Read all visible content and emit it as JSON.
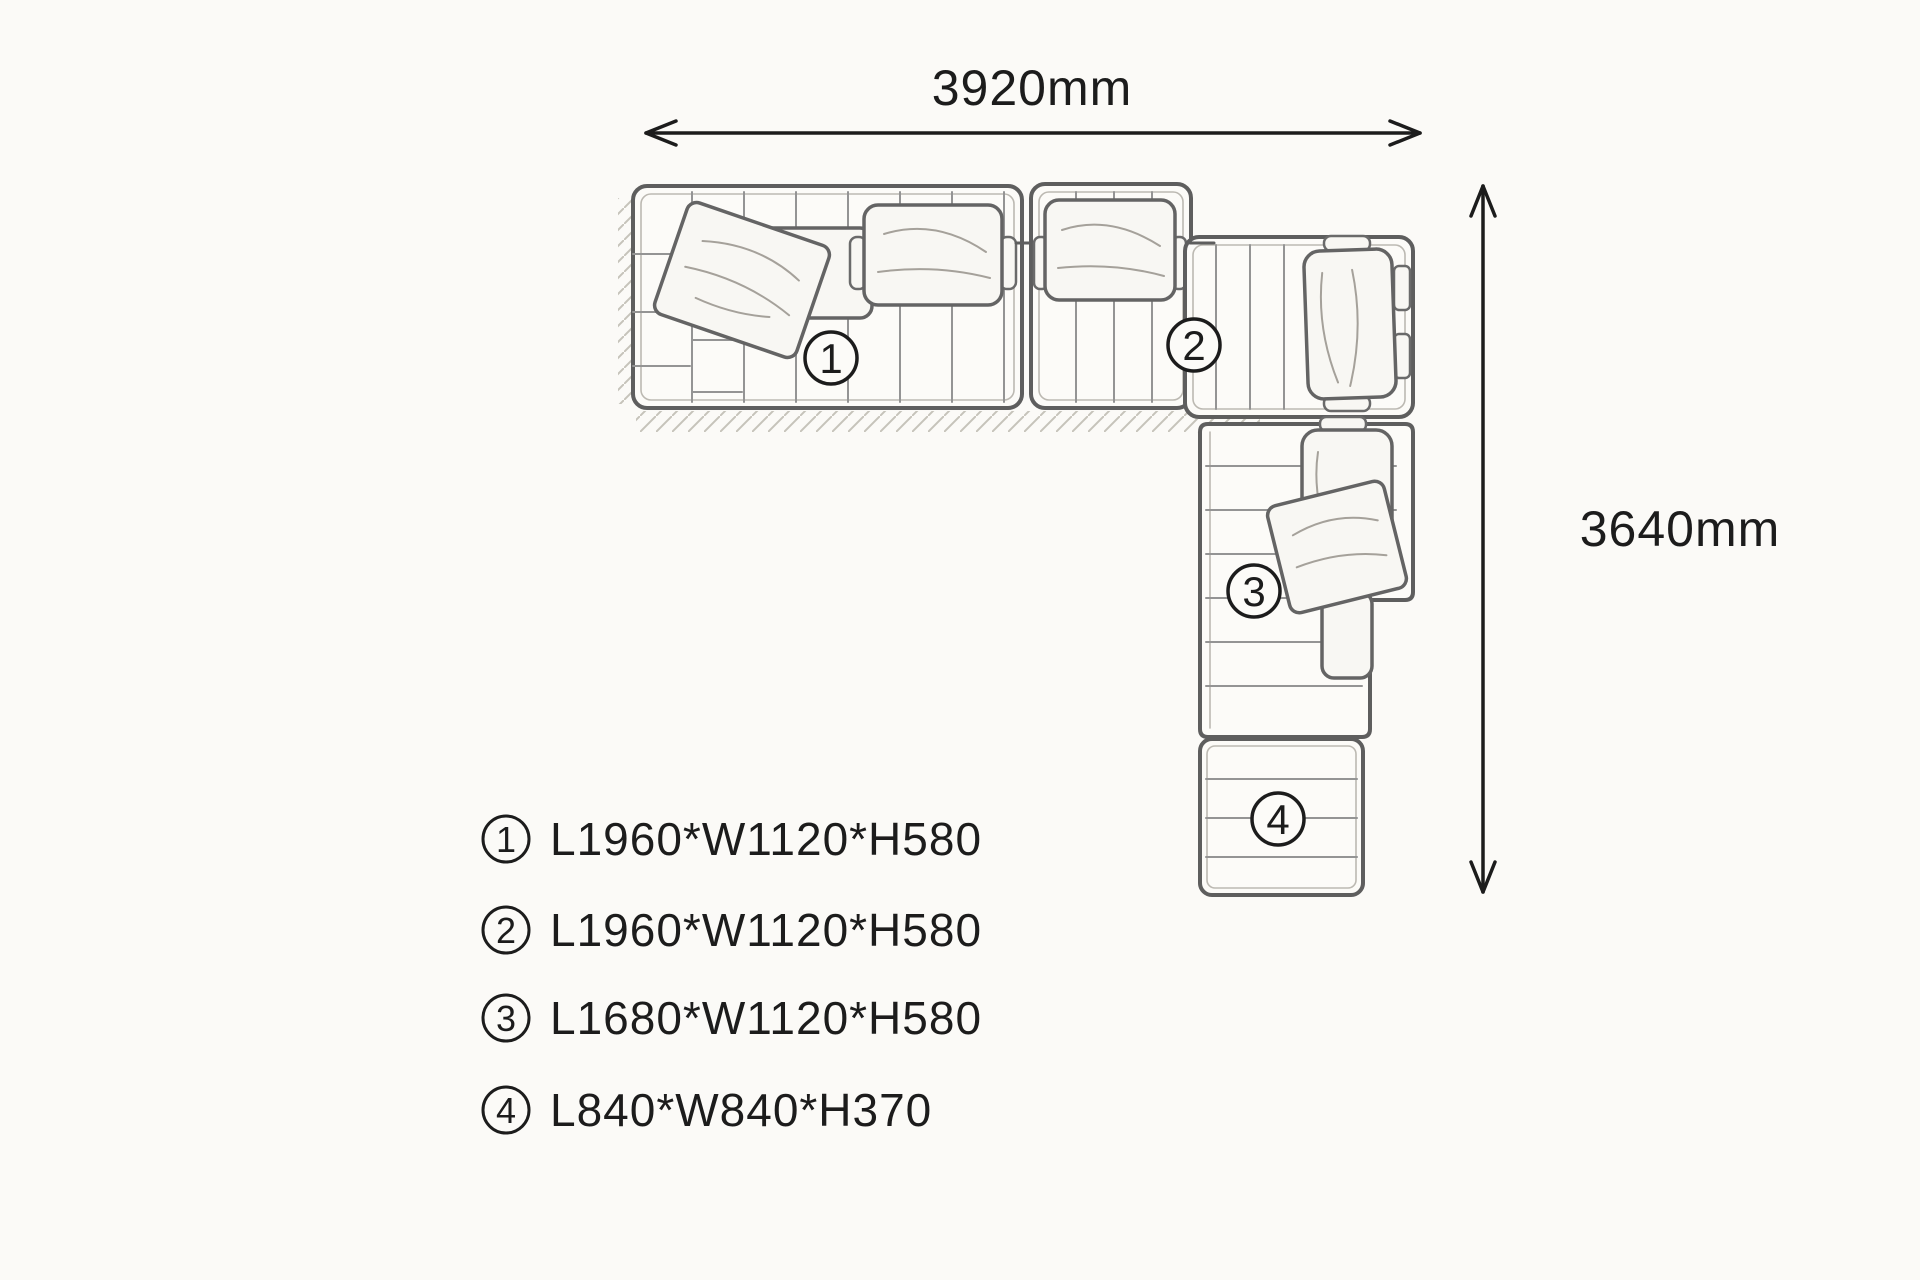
{
  "diagram": {
    "type": "sofa-sectional-plan",
    "dimensions": {
      "horizontal": "3920mm",
      "vertical": "3640mm"
    },
    "modules": [
      {
        "number": "1",
        "dims": "L1960*W1120*H580"
      },
      {
        "number": "2",
        "dims": "L1960*W1120*H580"
      },
      {
        "number": "3",
        "dims": "L1680*W1120*H580"
      },
      {
        "number": "4",
        "dims": "L840*W840*H370"
      }
    ],
    "colors": {
      "paper": "#fbfaf7",
      "ink": "#1c1c1c",
      "pencil": "#5e5e5e",
      "pencil_light": "#949494",
      "cushion_fill": "#f8f7f3"
    }
  }
}
